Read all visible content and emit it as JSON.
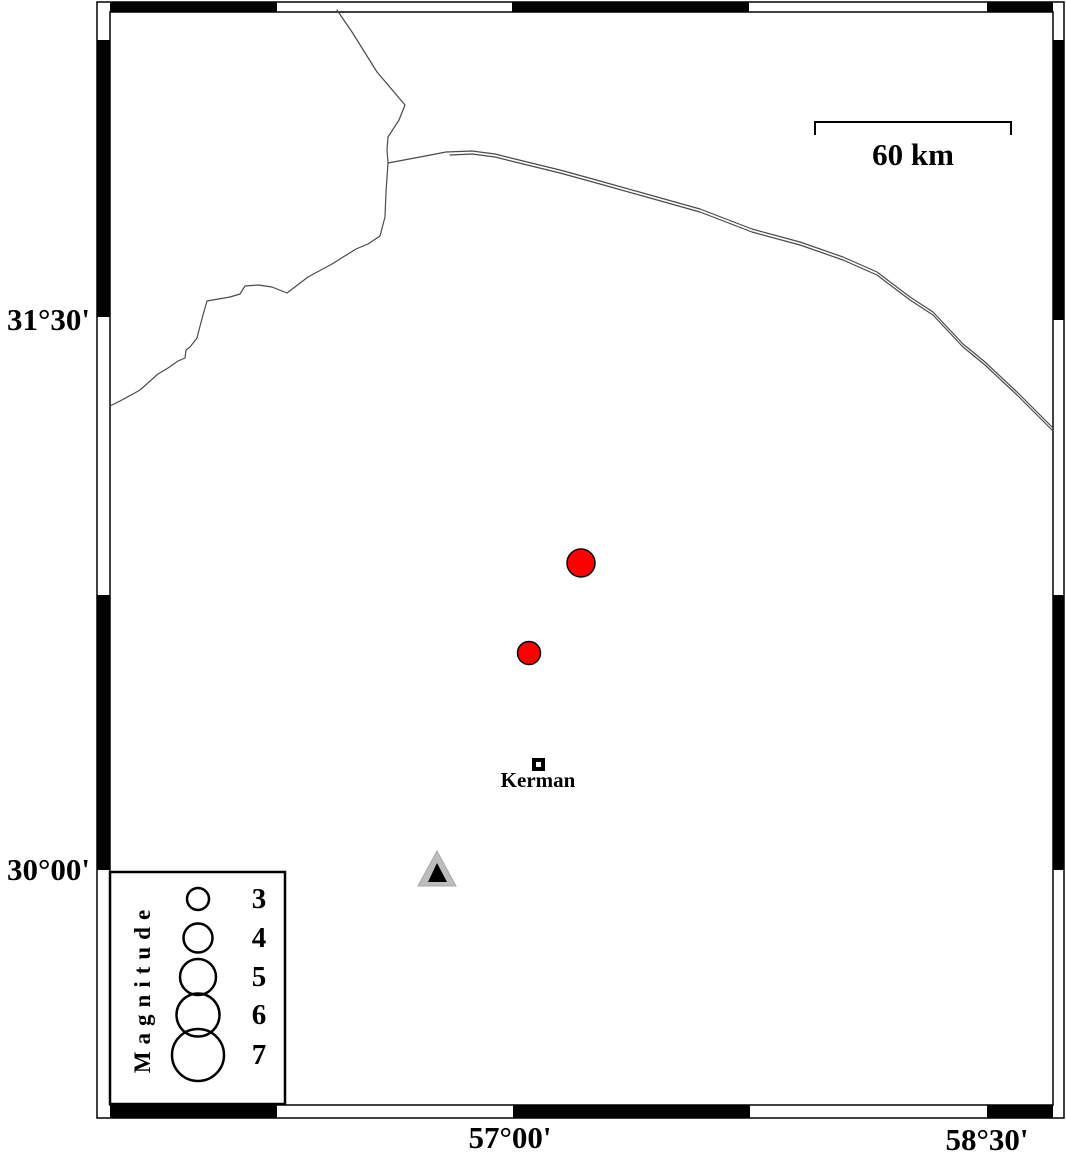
{
  "map": {
    "region_label": "Kerman area seismicity map",
    "frame": {
      "x_tick_labels": [
        {
          "text": "57°00'",
          "x_px": 510
        },
        {
          "text": "58°30'",
          "x_px": 987
        }
      ],
      "y_tick_labels": [
        {
          "text": "31°30'",
          "y_px": 320
        },
        {
          "text": "30°00'",
          "y_px": 870
        }
      ]
    },
    "scale_bar": {
      "label": "60 km",
      "length_km": 60
    },
    "city": {
      "name": "Kerman",
      "marker": "open-square",
      "x_px": 538,
      "y_px": 764,
      "approx_lon": "57.08°E",
      "approx_lat": "30.29°N"
    },
    "station": {
      "marker": "triangle",
      "x_px": 437,
      "y_px": 872,
      "approx_lon": "56.77°E",
      "approx_lat": "30.00°N"
    },
    "earthquakes": [
      {
        "x_px": 581,
        "y_px": 563,
        "radius_px": 14,
        "approx_magnitude": 4.0,
        "approx_lon": "57.22°E",
        "approx_lat": "30.84°N"
      },
      {
        "x_px": 529,
        "y_px": 653,
        "radius_px": 11.5,
        "approx_magnitude": 3.3,
        "approx_lon": "57.05°E",
        "approx_lat": "30.59°N"
      }
    ],
    "colors": {
      "earthquake_fill": "#ff0000",
      "marker_outline": "#000000",
      "station_fill": "#bdbdbd",
      "station_inner": "#000000",
      "road_line": "#4a4a4a",
      "frame": "#000000",
      "background": "#ffffff"
    }
  },
  "legend": {
    "title": "Magnitude",
    "circle_cx_px": 198,
    "entries": [
      {
        "label": "3",
        "cy_px": 899,
        "radius_px": 11
      },
      {
        "label": "4",
        "cy_px": 938,
        "radius_px": 14.5
      },
      {
        "label": "5",
        "cy_px": 977,
        "radius_px": 18
      },
      {
        "label": "6",
        "cy_px": 1015,
        "radius_px": 21.5
      },
      {
        "label": "7",
        "cy_px": 1055,
        "radius_px": 26
      }
    ]
  }
}
